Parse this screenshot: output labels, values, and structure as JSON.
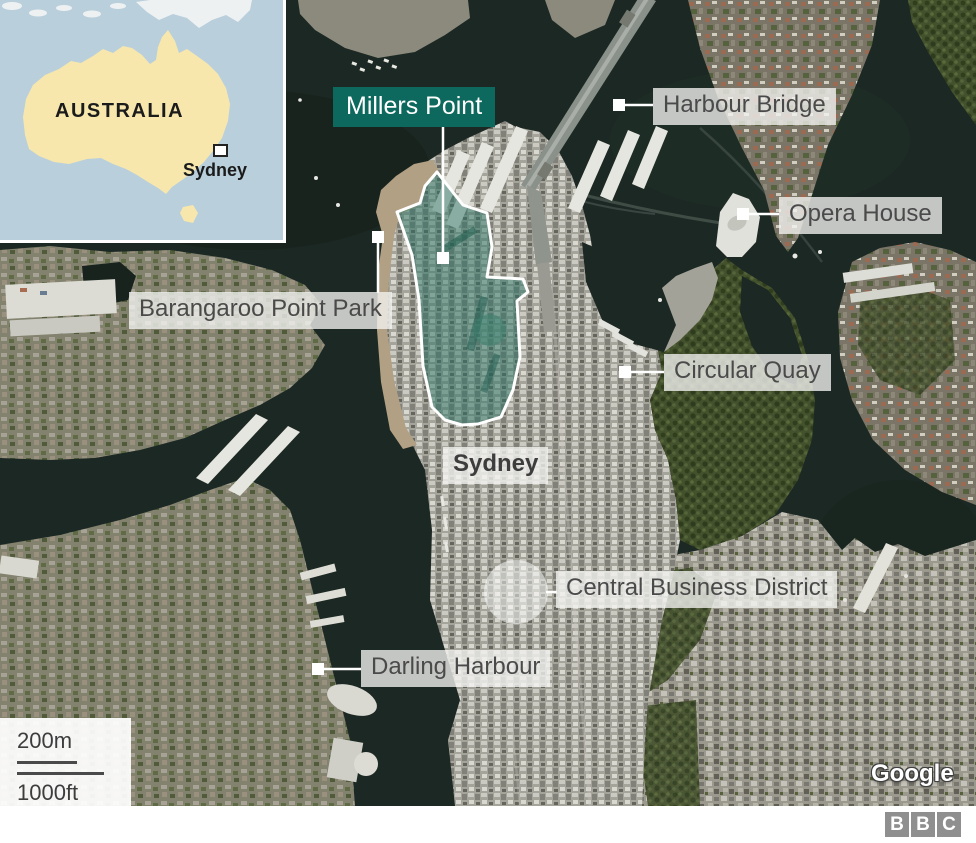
{
  "inset": {
    "region_label": "AUSTRALIA",
    "city_label": "Sydney"
  },
  "map": {
    "highlight": {
      "label": "Millers Point",
      "color": "#0d695e"
    },
    "labels": {
      "harbour_bridge": "Harbour Bridge",
      "opera_house": "Opera House",
      "barangaroo": "Barangaroo Point Park",
      "circular_quay": "Circular Quay",
      "sydney": "Sydney",
      "cbd": "Central Business District",
      "darling_harbour": "Darling Harbour"
    },
    "scale": {
      "metric": "200m",
      "imperial": "1000ft"
    },
    "attribution": "Google"
  },
  "footer": {
    "logo_letters": [
      "B",
      "B",
      "C"
    ]
  },
  "colors": {
    "water": "#1c2823",
    "label_bg": "#f3f3f1",
    "label_text": "#4a4a4a",
    "highlight_fill": "#2c7464",
    "inset_sea": "#b9cfdc",
    "inset_land": "#f7e7ad",
    "marker": "#ffffff",
    "bbc_gray": "#8f8f8f"
  }
}
